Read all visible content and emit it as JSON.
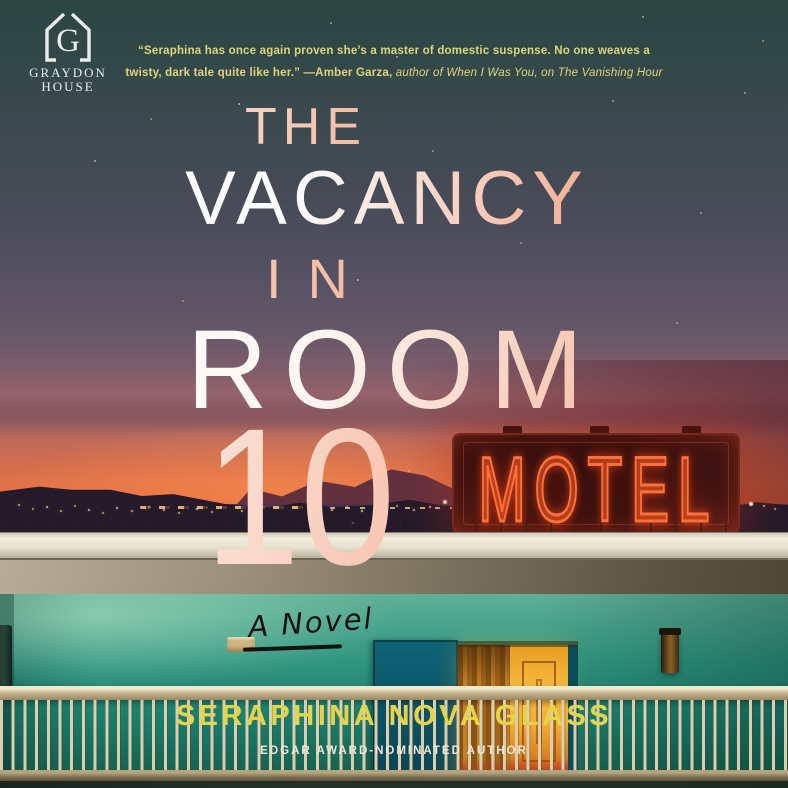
{
  "publisher": {
    "line1": "GRAYDON",
    "line2": "HOUSE",
    "monogram": "G"
  },
  "quote": {
    "line1": "“Seraphina has once again proven she’s a master of domestic suspense. No one weaves a",
    "line2_start": "twisty, dark tale quite like her.” ",
    "line2_credit": "—Amber Garza,",
    "line2_source": " author of When I Was You, on The Vanishing Hour"
  },
  "title": {
    "line1": "THE",
    "line2": "VACANCY",
    "line3": "IN",
    "line4": "ROOM",
    "line5": "10"
  },
  "subtitle": "A Novel",
  "scene": {
    "motel_sign_text": "MOTEL"
  },
  "author": {
    "name": "SERAPHINA NOVA GLASS",
    "tagline": "EDGAR AWARD-NOMINATED AUTHOR"
  },
  "colors": {
    "sky_top_teal": "#2b4641",
    "sunset_orange": "#e6693f",
    "neon_red_orange": "#ff7038",
    "title_gradient_start": "#ffffff",
    "title_gradient_end": "#ee8765",
    "quote_yellow": "#dcd67c",
    "author_yellow": "#e5d44a",
    "wall_teal": "#1c7f6e",
    "railing_tan": "#d9cfae"
  }
}
